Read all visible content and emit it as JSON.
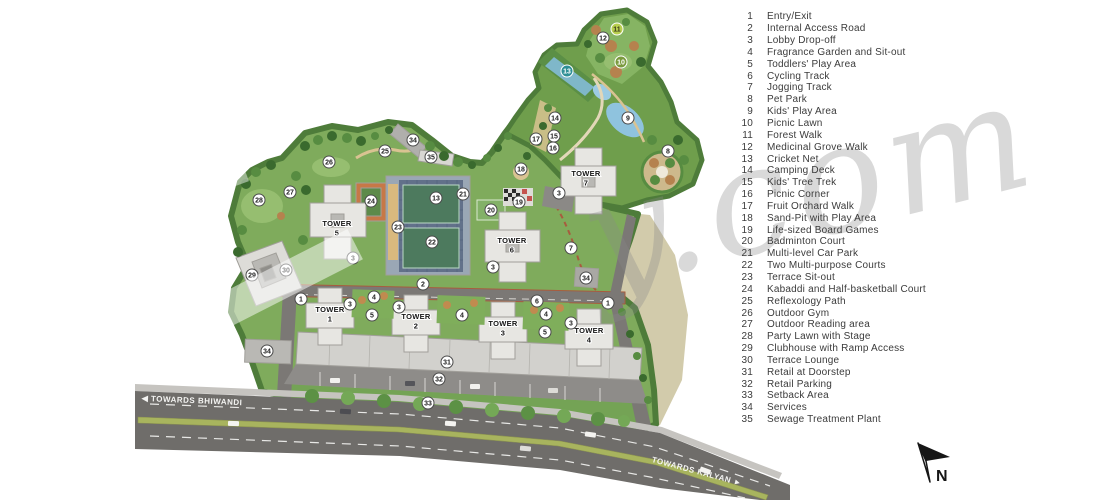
{
  "legend": {
    "items": [
      {
        "num": "1",
        "label": "Entry/Exit"
      },
      {
        "num": "2",
        "label": "Internal Access Road"
      },
      {
        "num": "3",
        "label": "Lobby Drop-off"
      },
      {
        "num": "4",
        "label": "Fragrance Garden and Sit-out"
      },
      {
        "num": "5",
        "label": "Toddlers' Play Area"
      },
      {
        "num": "6",
        "label": "Cycling Track"
      },
      {
        "num": "7",
        "label": "Jogging Track"
      },
      {
        "num": "8",
        "label": "Pet Park"
      },
      {
        "num": "9",
        "label": "Kids' Play Area"
      },
      {
        "num": "10",
        "label": "Picnic Lawn"
      },
      {
        "num": "11",
        "label": "Forest Walk"
      },
      {
        "num": "12",
        "label": "Medicinal Grove Walk"
      },
      {
        "num": "13",
        "label": "Cricket Net"
      },
      {
        "num": "14",
        "label": "Camping Deck"
      },
      {
        "num": "15",
        "label": "Kids' Tree Trek"
      },
      {
        "num": "16",
        "label": "Picnic Corner"
      },
      {
        "num": "17",
        "label": "Fruit Orchard Walk"
      },
      {
        "num": "18",
        "label": "Sand-Pit with Play Area"
      },
      {
        "num": "19",
        "label": "Life-sized Board Games"
      },
      {
        "num": "20",
        "label": "Badminton Court"
      },
      {
        "num": "21",
        "label": "Multi-level Car Park"
      },
      {
        "num": "22",
        "label": "Two Multi-purpose Courts"
      },
      {
        "num": "23",
        "label": "Terrace Sit-out"
      },
      {
        "num": "24",
        "label": "Kabaddi and Half-basketball Court"
      },
      {
        "num": "25",
        "label": "Reflexology Path"
      },
      {
        "num": "26",
        "label": "Outdoor Gym"
      },
      {
        "num": "27",
        "label": "Outdoor Reading area"
      },
      {
        "num": "28",
        "label": "Party Lawn with Stage"
      },
      {
        "num": "29",
        "label": "Clubhouse with Ramp Access"
      },
      {
        "num": "30",
        "label": "Terrace Lounge"
      },
      {
        "num": "31",
        "label": "Retail at Doorstep"
      },
      {
        "num": "32",
        "label": "Retail Parking"
      },
      {
        "num": "33",
        "label": "Setback Area"
      },
      {
        "num": "34",
        "label": "Services"
      },
      {
        "num": "35",
        "label": "Sewage Treatment Plant"
      }
    ]
  },
  "map": {
    "road_labels": {
      "bhiwandi": "◀ TOWARDS BHIWANDI",
      "kalyan": "TOWARDS KALYAN ►"
    },
    "north_label": "N",
    "watermark": "y.com",
    "towers": [
      {
        "name": "TOWER",
        "num": "5",
        "x": 337,
        "y": 226
      },
      {
        "name": "TOWER",
        "num": "6",
        "x": 512,
        "y": 243
      },
      {
        "name": "TOWER",
        "num": "7",
        "x": 586,
        "y": 176
      },
      {
        "name": "TOWER",
        "num": "1",
        "x": 330,
        "y": 312
      },
      {
        "name": "TOWER",
        "num": "2",
        "x": 416,
        "y": 319
      },
      {
        "name": "TOWER",
        "num": "3",
        "x": 503,
        "y": 326
      },
      {
        "name": "TOWER",
        "num": "4",
        "x": 589,
        "y": 333
      }
    ],
    "markers": [
      {
        "n": "1",
        "x": 301,
        "y": 299
      },
      {
        "n": "1",
        "x": 608,
        "y": 303
      },
      {
        "n": "2",
        "x": 423,
        "y": 284
      },
      {
        "n": "3",
        "x": 353,
        "y": 258
      },
      {
        "n": "3",
        "x": 493,
        "y": 267
      },
      {
        "n": "3",
        "x": 559,
        "y": 193
      },
      {
        "n": "3",
        "x": 350,
        "y": 304
      },
      {
        "n": "3",
        "x": 399,
        "y": 307
      },
      {
        "n": "3",
        "x": 571,
        "y": 323
      },
      {
        "n": "4",
        "x": 374,
        "y": 297
      },
      {
        "n": "4",
        "x": 462,
        "y": 315
      },
      {
        "n": "4",
        "x": 546,
        "y": 314
      },
      {
        "n": "5",
        "x": 372,
        "y": 315
      },
      {
        "n": "5",
        "x": 545,
        "y": 332
      },
      {
        "n": "6",
        "x": 537,
        "y": 301
      },
      {
        "n": "7",
        "x": 571,
        "y": 248
      },
      {
        "n": "8",
        "x": 668,
        "y": 151
      },
      {
        "n": "9",
        "x": 628,
        "y": 118
      },
      {
        "n": "10",
        "x": 621,
        "y": 62,
        "s": "g"
      },
      {
        "n": "11",
        "x": 617,
        "y": 29,
        "s": "y"
      },
      {
        "n": "12",
        "x": 603,
        "y": 38
      },
      {
        "n": "13",
        "x": 567,
        "y": 71,
        "s": "t"
      },
      {
        "n": "13",
        "x": 436,
        "y": 198
      },
      {
        "n": "14",
        "x": 555,
        "y": 118
      },
      {
        "n": "15",
        "x": 554,
        "y": 136
      },
      {
        "n": "16",
        "x": 553,
        "y": 148
      },
      {
        "n": "17",
        "x": 536,
        "y": 139
      },
      {
        "n": "18",
        "x": 521,
        "y": 169
      },
      {
        "n": "19",
        "x": 519,
        "y": 202
      },
      {
        "n": "20",
        "x": 491,
        "y": 210
      },
      {
        "n": "21",
        "x": 463,
        "y": 194
      },
      {
        "n": "22",
        "x": 432,
        "y": 242
      },
      {
        "n": "23",
        "x": 398,
        "y": 227
      },
      {
        "n": "24",
        "x": 371,
        "y": 201
      },
      {
        "n": "25",
        "x": 385,
        "y": 151
      },
      {
        "n": "26",
        "x": 329,
        "y": 162
      },
      {
        "n": "27",
        "x": 290,
        "y": 192
      },
      {
        "n": "28",
        "x": 259,
        "y": 200
      },
      {
        "n": "29",
        "x": 252,
        "y": 275
      },
      {
        "n": "30",
        "x": 286,
        "y": 270
      },
      {
        "n": "31",
        "x": 447,
        "y": 362
      },
      {
        "n": "32",
        "x": 439,
        "y": 379
      },
      {
        "n": "33",
        "x": 428,
        "y": 403
      },
      {
        "n": "34",
        "x": 413,
        "y": 140
      },
      {
        "n": "34",
        "x": 586,
        "y": 278
      },
      {
        "n": "34",
        "x": 267,
        "y": 351
      },
      {
        "n": "35",
        "x": 431,
        "y": 157
      }
    ]
  },
  "colors": {
    "base_green": "#7fab5c",
    "rim_green": "#4e7c3a",
    "light_lawn": "#96be70",
    "water": "#8fc3de",
    "khaki": "#cdc5a2",
    "asphalt": "#6f6d6a",
    "building": "#e7e6e2",
    "marker_styles": {
      "w": {
        "bg": "#ffffff",
        "fg": "#222222",
        "stroke": "#4a4a4a"
      },
      "g": {
        "bg": "#7a9a3d",
        "fg": "#ffffff",
        "stroke": "#ffffff"
      },
      "y": {
        "bg": "#b8cf4e",
        "fg": "#3a3a1c",
        "stroke": "#ffffff"
      },
      "t": {
        "bg": "#2e8f96",
        "fg": "#ffffff",
        "stroke": "#ffffff"
      }
    }
  }
}
